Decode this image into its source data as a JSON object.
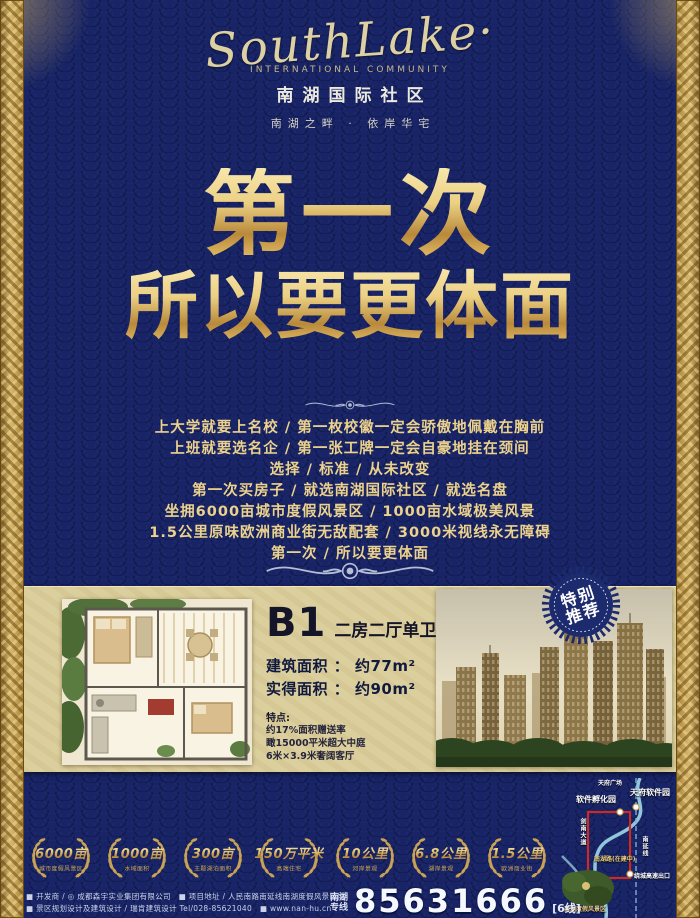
{
  "brand": {
    "logo_script": "SouthLake·",
    "logo_sub": "International community",
    "name_cn": "南湖国际社区",
    "tagline": "南湖之畔 · 依岸华宅"
  },
  "headline": {
    "line1": "第一次",
    "line2": "所以要更体面"
  },
  "body": {
    "lines": [
      "上大学就要上名校 / 第一枚校徽一定会骄傲地佩戴在胸前",
      "上班就要选名企 / 第一张工牌一定会自豪地挂在颈间",
      "选择 / 标准 / 从未改变",
      "第一次买房子 / 就选南湖国际社区 / 就选名盘",
      "坐拥6000亩城市度假风景区 / 1000亩水域极美风景",
      "1.5公里原味欧洲商业街无敌配套 / 3000米视线永无障碍",
      "第一次 / 所以要更体面"
    ]
  },
  "product": {
    "special_badge_line1": "特别",
    "special_badge_line2": "推荐",
    "unit_code": "B1",
    "unit_type": "二房二厅单卫",
    "area_build": "建筑面积 ： 约77m²",
    "area_real": "实得面积 ： 约90m²",
    "features_title": "特点:",
    "features": [
      "约17%面积赠送率",
      "瞰15000平米超大中庭",
      "6米×3.9米奢阔客厅"
    ]
  },
  "awards": {
    "items": [
      {
        "value": "6000亩",
        "label": "城市度假风景区"
      },
      {
        "value": "1000亩",
        "label": "水域面积"
      },
      {
        "value": "300亩",
        "label": "主题湖泊面积"
      },
      {
        "value": "150万平米",
        "label": "高端住宅"
      },
      {
        "value": "10公里",
        "label": "河岸景观"
      },
      {
        "value": "6.8公里",
        "label": "湖岸景观"
      },
      {
        "value": "1.5公里",
        "label": "欧洲商业街"
      }
    ]
  },
  "map": {
    "square": "天府广场",
    "incubator": "软件孵化园",
    "software_park": "天府软件园",
    "road_left": "剑南大道",
    "road_right": "南延线",
    "road_mid": "南湖路(在建中)",
    "exit": "绕城高速出口",
    "resort": "南湖度假风景区"
  },
  "footer": {
    "line1": "■ 开发商 / ◎ 成都森宇实业集团有限公司　■ 项目地址 / 人民南路南延线南湖度假风景区内",
    "line2": "■ 景区规划设计及建筑设计 / 瑞肯建筑设计 Tel/028-85621040　■ www.nan-hu.cn",
    "hotline_l1": "南湖",
    "hotline_l2": "专线",
    "phone": "85631666",
    "phone_suffix": "[6线]"
  },
  "colors": {
    "navy": "#182465",
    "gold": "#d9b35c",
    "cream": "#dccf9e",
    "route_red": "#cc2a22"
  }
}
